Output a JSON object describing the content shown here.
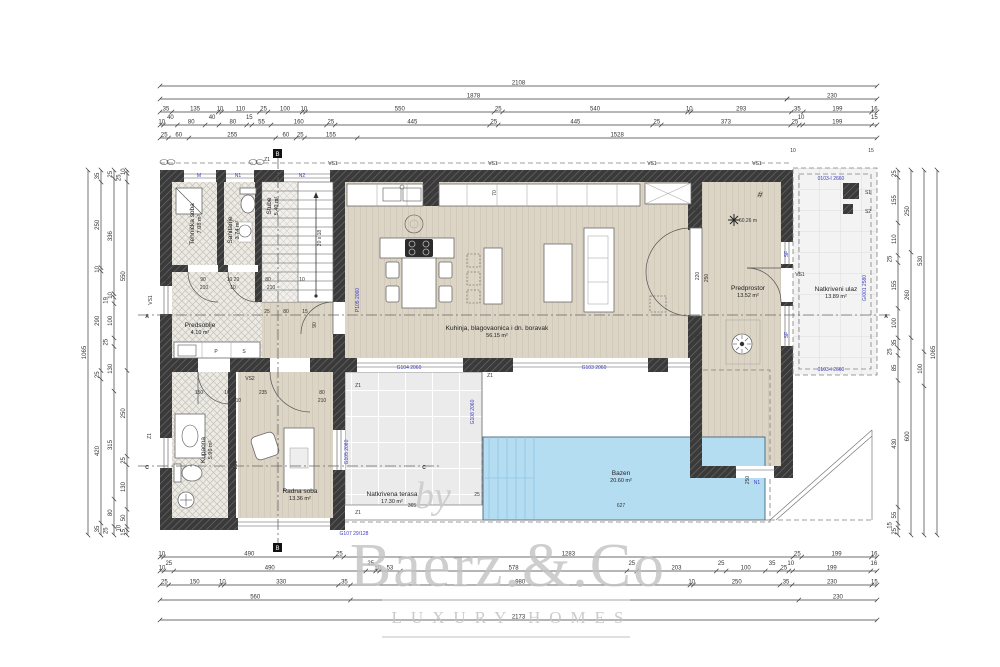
{
  "watermark": {
    "by": "by",
    "name": "Baerz.&.Co",
    "tagline": "LUXURY HOMES"
  },
  "rooms": {
    "tehnicka": {
      "label": "Tehnička soba",
      "area": "7.08 m²"
    },
    "sanitarije": {
      "label": "Sanitarije",
      "area": "3.74 m²"
    },
    "predsoblje": {
      "label": "Predsoblje",
      "area": "4.10 m²"
    },
    "stube": {
      "label": "Stube",
      "area": "5.40 m²"
    },
    "kuhinja": {
      "label": "Kuhinja, blagovaonica i dn. boravak",
      "area": "56.15 m²"
    },
    "predprostor": {
      "label": "Predprostor",
      "area": "13.52 m²"
    },
    "ulaz": {
      "label": "Natkriveni ulaz",
      "area": "13.89 m²"
    },
    "kupaona": {
      "label": "Kupaona",
      "area": "5.96 m²"
    },
    "radna": {
      "label": "Radna soba",
      "area": "13.36 m²"
    },
    "terasa": {
      "label": "Natkrivena terasa",
      "area": "17.30 m²"
    },
    "bazen": {
      "label": "Bazen",
      "area": "20.60 m²"
    }
  },
  "colors": {
    "pool": "#b5ddf2",
    "wall": "#3a3a3a",
    "code_blue": "#3c3cc0",
    "wood": "#dcd4c5"
  },
  "dim_chains": [
    {
      "dir": "h",
      "x1": 160,
      "x2": 877,
      "y": 86,
      "values": [
        2108
      ]
    },
    {
      "dir": "h",
      "x1": 160,
      "x2": 787,
      "y": 99,
      "values": [
        1878
      ]
    },
    {
      "dir": "h",
      "x1": 787,
      "x2": 877,
      "y": 99,
      "values": [
        230
      ]
    },
    {
      "dir": "h",
      "x1": 160,
      "x2": 877,
      "y": 112,
      "values": [
        35,
        135,
        10,
        110,
        25,
        100,
        10,
        550,
        25,
        540,
        10,
        293,
        35,
        199,
        16
      ]
    },
    {
      "dir": "h",
      "x1": 160,
      "x2": 877,
      "y": 125,
      "values": [
        10,
        40,
        80,
        40,
        80,
        15,
        55,
        160,
        25,
        445,
        25,
        445,
        25,
        373,
        25,
        10,
        199,
        15
      ]
    },
    {
      "dir": "h",
      "x1": 160,
      "x2": 877,
      "y": 138,
      "values": [
        25,
        60,
        255,
        60,
        25,
        155,
        1528
      ]
    },
    {
      "dir": "h",
      "x1": 160,
      "x2": 877,
      "y": 557,
      "values": [
        10,
        490,
        25,
        1283,
        25,
        199,
        16
      ]
    },
    {
      "dir": "h",
      "x1": 160,
      "x2": 877,
      "y": 571,
      "values": [
        10,
        25,
        490,
        25,
        10,
        53,
        578,
        25,
        203,
        25,
        100,
        35,
        25,
        10,
        199,
        16
      ]
    },
    {
      "dir": "h",
      "x1": 160,
      "x2": 877,
      "y": 585,
      "values": [
        25,
        150,
        10,
        330,
        35,
        980,
        10,
        250,
        35,
        230,
        15
      ]
    },
    {
      "dir": "h",
      "x1": 160,
      "x2": 877,
      "y": 600,
      "values": [
        560,
        -1318,
        230
      ]
    },
    {
      "dir": "h",
      "x1": 160,
      "x2": 877,
      "y": 620,
      "values": [
        2173
      ]
    },
    {
      "dir": "v",
      "y1": 170,
      "y2": 535,
      "x": 88,
      "values": [
        1065
      ]
    },
    {
      "dir": "v",
      "y1": 170,
      "y2": 535,
      "x": 101,
      "values": [
        35,
        250,
        10,
        290,
        25,
        420,
        35
      ]
    },
    {
      "dir": "v",
      "y1": 170,
      "y2": 535,
      "x": 114,
      "values": [
        25,
        336,
        10,
        19,
        100,
        25,
        130,
        315,
        80,
        25
      ]
    },
    {
      "dir": "v",
      "y1": 170,
      "y2": 535,
      "x": 127,
      "values": [
        10,
        25,
        550,
        250,
        25,
        130,
        50,
        10,
        15
      ]
    },
    {
      "dir": "v",
      "y1": 170,
      "y2": 535,
      "x": 898,
      "values": [
        25,
        155,
        110,
        25,
        155,
        100,
        35,
        25,
        85,
        430,
        55,
        15,
        25
      ]
    },
    {
      "dir": "v",
      "y1": 170,
      "y2": 535,
      "x": 911,
      "values": [
        250,
        260,
        600
      ]
    },
    {
      "dir": "v",
      "y1": 170,
      "y2": 535,
      "x": 924,
      "values": [
        530,
        100,
        -435
      ]
    },
    {
      "dir": "v",
      "y1": 170,
      "y2": 535,
      "x": 937,
      "values": [
        1065
      ]
    }
  ],
  "annotations": [
    {
      "t": "VS1",
      "x": 333,
      "y": 165
    },
    {
      "t": "VS1",
      "x": 493,
      "y": 165
    },
    {
      "t": "VS1",
      "x": 652,
      "y": 165
    },
    {
      "t": "VS1",
      "x": 757,
      "y": 165
    },
    {
      "t": "VS1",
      "x": 152,
      "y": 300,
      "r": -90
    },
    {
      "t": "VS1",
      "x": 800,
      "y": 276
    },
    {
      "t": "VS2",
      "x": 250,
      "y": 380
    },
    {
      "t": "Z1",
      "x": 267,
      "y": 161
    },
    {
      "t": "Z1",
      "x": 358,
      "y": 387
    },
    {
      "t": "Z1",
      "x": 490,
      "y": 377
    },
    {
      "t": "Z1",
      "x": 358,
      "y": 514
    },
    {
      "t": "Z1",
      "x": 151,
      "y": 436,
      "r": -90
    },
    {
      "t": "S1",
      "x": 868,
      "y": 194
    },
    {
      "t": "S2",
      "x": 868,
      "y": 213
    },
    {
      "t": "A",
      "x": 147,
      "y": 318,
      "s": 9,
      "b": 1
    },
    {
      "t": "A",
      "x": 886,
      "y": 318,
      "s": 9,
      "b": 1
    },
    {
      "t": "C",
      "x": 147,
      "y": 469,
      "s": 9,
      "b": 1
    },
    {
      "t": "C",
      "x": 424,
      "y": 469,
      "s": 9,
      "b": 1
    },
    {
      "t": "35",
      "x": 166,
      "y": 281
    },
    {
      "t": "90",
      "x": 203,
      "y": 281
    },
    {
      "t": "10 20",
      "x": 233,
      "y": 281
    },
    {
      "t": "80",
      "x": 268,
      "y": 281
    },
    {
      "t": "10",
      "x": 302,
      "y": 281
    },
    {
      "t": "210",
      "x": 204,
      "y": 289
    },
    {
      "t": "10",
      "x": 233,
      "y": 289
    },
    {
      "t": "210",
      "x": 271,
      "y": 289
    },
    {
      "t": "25",
      "x": 267,
      "y": 313
    },
    {
      "t": "80",
      "x": 286,
      "y": 313
    },
    {
      "t": "15",
      "x": 305,
      "y": 313
    },
    {
      "t": "150",
      "x": 199,
      "y": 394
    },
    {
      "t": "10",
      "x": 227,
      "y": 394
    },
    {
      "t": "235",
      "x": 263,
      "y": 394
    },
    {
      "t": "80",
      "x": 322,
      "y": 394
    },
    {
      "t": "210",
      "x": 237,
      "y": 402
    },
    {
      "t": "210",
      "x": 322,
      "y": 402
    },
    {
      "t": "295",
      "x": 237,
      "y": 465,
      "r": -90
    },
    {
      "t": "90",
      "x": 316,
      "y": 325,
      "r": -90
    },
    {
      "t": "365",
      "x": 412,
      "y": 507
    },
    {
      "t": "25",
      "x": 477,
      "y": 496
    },
    {
      "t": "627",
      "x": 621,
      "y": 507
    },
    {
      "t": "250",
      "x": 749,
      "y": 480,
      "r": -90
    },
    {
      "t": "175",
      "x": 699,
      "y": 210,
      "r": -90
    },
    {
      "t": "220",
      "x": 699,
      "y": 276,
      "r": -90
    },
    {
      "t": "250",
      "x": 708,
      "y": 278,
      "r": -90
    },
    {
      "t": "135",
      "x": 699,
      "y": 337,
      "r": -90
    },
    {
      "t": "70",
      "x": 496,
      "y": 193,
      "r": -90
    },
    {
      "t": "20 x 18",
      "x": 321,
      "y": 238,
      "r": -90
    },
    {
      "t": "10",
      "x": 793,
      "y": 152
    },
    {
      "t": "15",
      "x": 871,
      "y": 152
    },
    {
      "t": "60.26 m",
      "x": 748,
      "y": 222,
      "s": 4
    },
    {
      "t": "P",
      "x": 216,
      "y": 353
    },
    {
      "t": "S",
      "x": 244,
      "y": 353
    },
    {
      "t": "M",
      "x": 199,
      "y": 177,
      "c": "b"
    },
    {
      "t": "N1",
      "x": 238,
      "y": 177,
      "c": "b"
    },
    {
      "t": "N2",
      "x": 302,
      "y": 177,
      "c": "b"
    },
    {
      "t": "P105 2060",
      "x": 359,
      "y": 300,
      "r": -90,
      "c": "b"
    },
    {
      "t": "G104 2060",
      "x": 409,
      "y": 369,
      "c": "b"
    },
    {
      "t": "G103 2060",
      "x": 594,
      "y": 369,
      "c": "b"
    },
    {
      "t": "G108 2060",
      "x": 474,
      "y": 412,
      "r": -90,
      "c": "b"
    },
    {
      "t": "G105 2060",
      "x": 348,
      "y": 452,
      "r": -90,
      "c": "b"
    },
    {
      "t": "G107 29/128",
      "x": 354,
      "y": 535,
      "c": "b"
    },
    {
      "t": "0103-I 2660",
      "x": 831,
      "y": 180,
      "c": "b"
    },
    {
      "t": "0103-I 2660",
      "x": 831,
      "y": 371,
      "c": "b"
    },
    {
      "t": "G/001 2580",
      "x": 866,
      "y": 288,
      "r": -90,
      "c": "b"
    },
    {
      "t": "N1",
      "x": 757,
      "y": 484,
      "c": "b"
    },
    {
      "t": "SF",
      "x": 788,
      "y": 254,
      "r": -90,
      "c": "b"
    },
    {
      "t": "SF",
      "x": 788,
      "y": 335,
      "r": -90,
      "c": "b"
    }
  ]
}
